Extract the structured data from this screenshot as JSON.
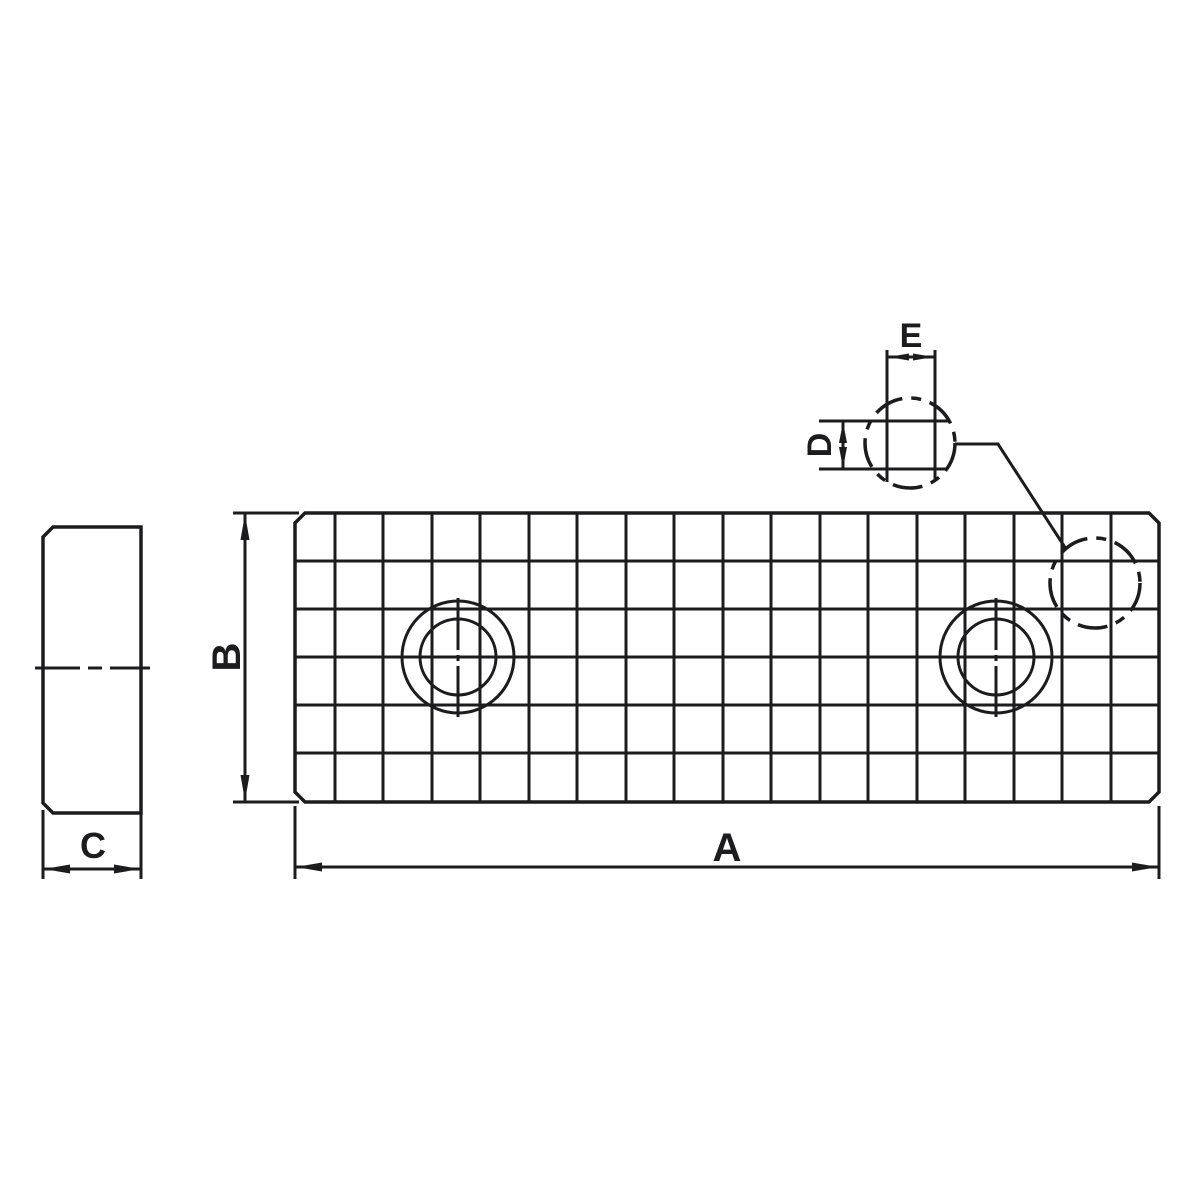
{
  "drawing": {
    "title": "serrated-jaw-plate-technical-drawing",
    "description": "Two-view technical drawing of a serrated vise jaw plate with two counterbored holes and a magnified detail callout of the serration grid",
    "dimension_labels": {
      "A": "A",
      "B": "B",
      "C": "C",
      "D": "D",
      "E": "E"
    },
    "views": {
      "side_view": {
        "width_label": "C"
      },
      "front_view": {
        "length_label": "A",
        "height_label": "B",
        "grid_columns": 18,
        "grid_rows": 6,
        "hole_count": 2
      },
      "detail_view": {
        "pitch_width_label": "E",
        "pitch_height_label": "D"
      }
    },
    "colors": {
      "part_fill": "#d3d5d7",
      "line": "#1c1c1e",
      "background": "#ffffff"
    }
  }
}
